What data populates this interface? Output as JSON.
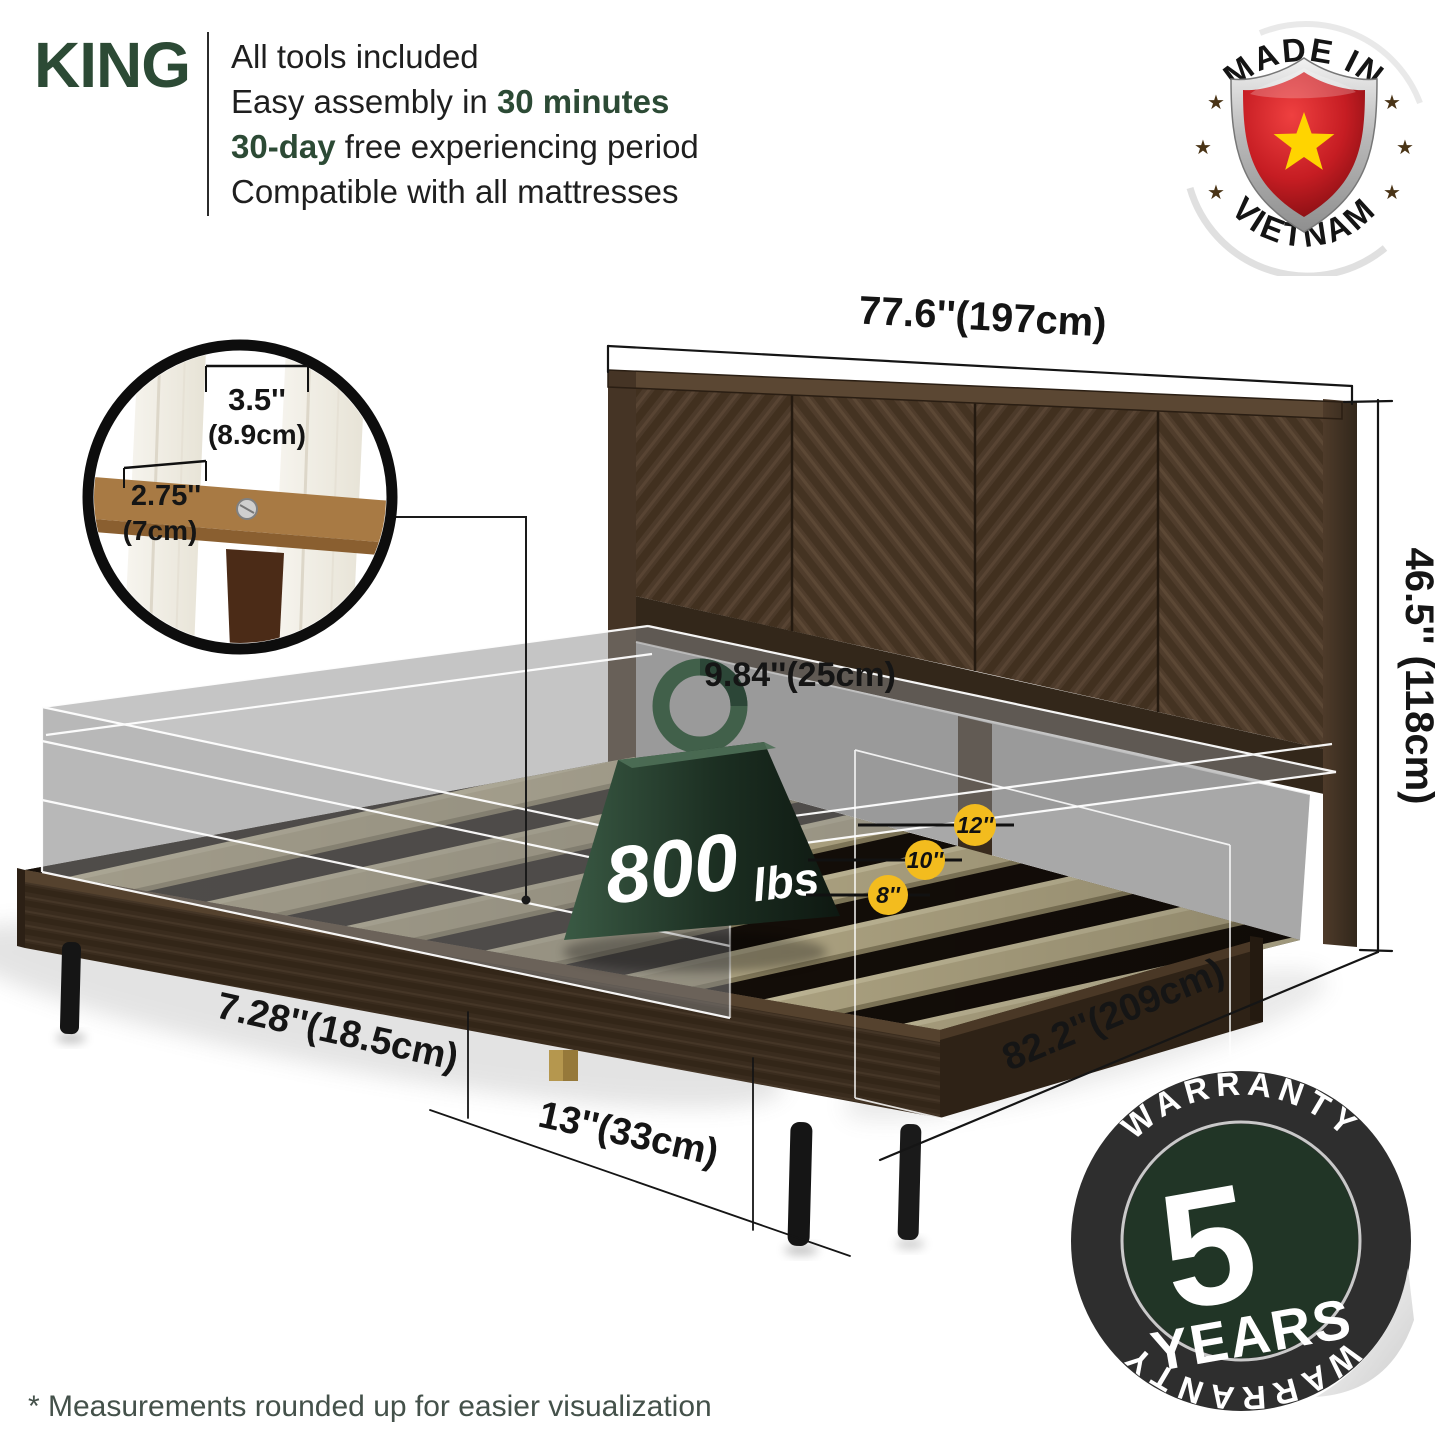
{
  "colors": {
    "accent_green": "#2c4a35",
    "badge_yellow": "#f3bc1e",
    "flag_red": "#c61d23",
    "flag_star_yellow": "#ffd400",
    "wood_dark": "#4a3729",
    "warranty_ring_black": "#2e2e2e",
    "warranty_inner_green": "#213526"
  },
  "header": {
    "size_label": "KING",
    "features": [
      {
        "pre": "All tools included",
        "bold": "",
        "post": ""
      },
      {
        "pre": "Easy assembly in ",
        "bold": "30 minutes",
        "post": ""
      },
      {
        "pre": "",
        "bold": "30-day",
        "post": " free experiencing period"
      },
      {
        "pre": "Compatible with all mattresses",
        "bold": "",
        "post": ""
      }
    ]
  },
  "made_in_badge": {
    "top": "MADE IN",
    "bottom": "VIETNAM"
  },
  "dimensions": {
    "headboard_width": "77.6''(197cm)",
    "headboard_height": "46.5'' (118cm)",
    "bed_length": "82.2''(209cm)",
    "under_bed_clearance": "9.84''(25cm)",
    "frame_height": "7.28''(18.5cm)",
    "leg_spacing": "13''(33cm)",
    "slat_gap_in": "3.5''",
    "slat_gap_cm": "(8.9cm)",
    "slat_width_in": "2.75''",
    "slat_width_cm": "(7cm)",
    "height_option_small": "8''",
    "height_option_medium": "10''",
    "height_option_large": "12''"
  },
  "weight_capacity": {
    "value": "800",
    "unit": "lbs"
  },
  "warranty_badge": {
    "arc_top": "WARRANTY",
    "number": "5",
    "label": "YEARS",
    "arc_bottom": "WARRANTY"
  },
  "footnote": "* Measurements rounded up for easier visualization"
}
